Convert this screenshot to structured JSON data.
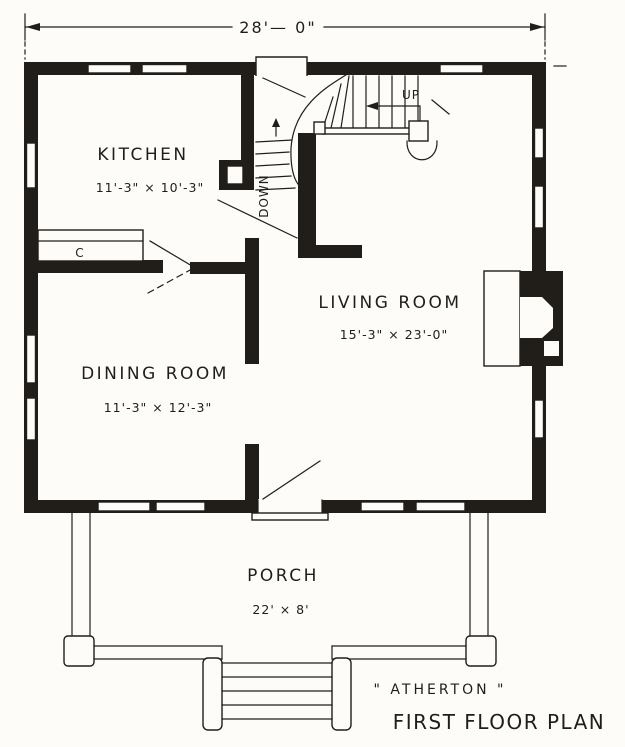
{
  "title": {
    "house_name": "\" ATHERTON \"",
    "plan_name": "FIRST FLOOR PLAN"
  },
  "dimension": {
    "overall_width": "28'— 0\""
  },
  "rooms": {
    "kitchen": {
      "name": "KITCHEN",
      "size": "11'-3\" × 10'-3\""
    },
    "living": {
      "name": "LIVING ROOM",
      "size": "15'-3\" × 23'-0\""
    },
    "dining": {
      "name": "DINING ROOM",
      "size": "11'-3\" × 12'-3\""
    },
    "porch": {
      "name": "PORCH",
      "size": "22' × 8'"
    }
  },
  "stairs": {
    "up_label": "UP",
    "down_label": "DOWN"
  },
  "fixtures": {
    "counter_label": "C"
  },
  "colors": {
    "ink": "#211e1a",
    "paper": "#fdfcf9"
  }
}
